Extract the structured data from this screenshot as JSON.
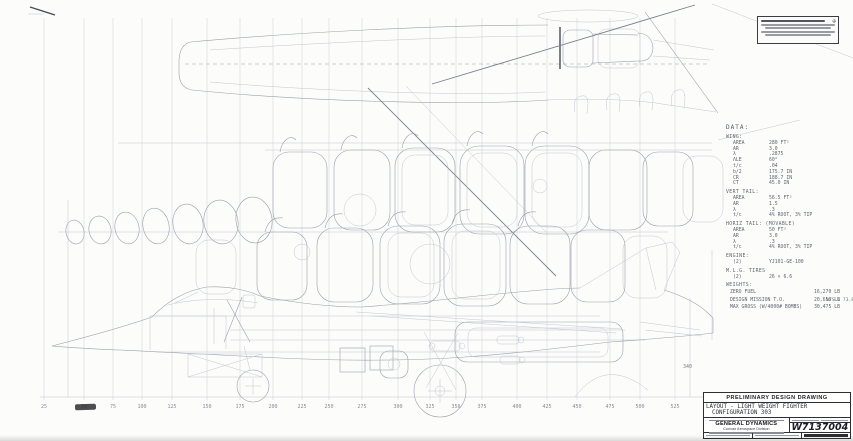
{
  "sheet": {
    "data_block": {
      "heading": "DATA:",
      "sections": [
        {
          "title": "WING:",
          "rows": [
            {
              "label": "AREA",
              "value": "280 FT²"
            },
            {
              "label": "AR",
              "value": "3.0"
            },
            {
              "label": "λ",
              "value": ".2875"
            },
            {
              "label": "ΛLE",
              "value": "60°"
            },
            {
              "label": "t/c",
              "value": ".04"
            },
            {
              "label": "b/2",
              "value": "175.7 IN"
            },
            {
              "label": "CR",
              "value": "188.7 IN"
            },
            {
              "label": "CT",
              "value": "45.0 IN"
            }
          ]
        },
        {
          "title": "VERT TAIL:",
          "rows": [
            {
              "label": "AREA",
              "value": "56.5 FT²"
            },
            {
              "label": "AR",
              "value": "1.5"
            },
            {
              "label": "λ",
              "value": ".3"
            },
            {
              "label": "t/c",
              "value": "4% ROOT, 3% TIP"
            }
          ]
        },
        {
          "title": "HORIZ TAIL: (MOVABLE)",
          "rows": [
            {
              "label": "AREA",
              "value": "50 FT²"
            },
            {
              "label": "AR",
              "value": "3.0"
            },
            {
              "label": "λ",
              "value": ".3"
            },
            {
              "label": "t/c",
              "value": "4% ROOT, 3% TIP"
            }
          ]
        },
        {
          "title": "ENGINE:",
          "rows": [
            {
              "label": "(2)",
              "value": "YJ101-GE-100"
            }
          ]
        },
        {
          "title": "M.L.G. TIRES",
          "rows": [
            {
              "label": "(2)",
              "value": "26 × 6.6"
            }
          ]
        },
        {
          "title": "WEIGHTS:",
          "rows": [
            {
              "label": "ZERO FUEL",
              "value": "16,270 LB"
            },
            {
              "label": "DESIGN MISSION T.O.",
              "value": "20,650 LB"
            },
            {
              "label": "MAX GROSS (W/4000# BOMBS)",
              "value": "30,475 LB"
            }
          ],
          "note": "W/S = 73.8"
        }
      ]
    },
    "station_scale": {
      "labels": [
        "25",
        "50",
        "75",
        "100",
        "125",
        "150",
        "175",
        "200",
        "225",
        "250",
        "275",
        "300",
        "325",
        "350",
        "375",
        "400",
        "425",
        "450",
        "475",
        "500",
        "525"
      ]
    },
    "annotations": {
      "fin_station": "340"
    },
    "title_block": {
      "header": "PRELIMINARY DESIGN DRAWING",
      "title_line1": "LAYOUT - LIGHT WEIGHT FIGHTER",
      "title_line2": "CONFIGURATION  303",
      "company": "GENERAL DYNAMICS",
      "division": "Convair Aerospace Division",
      "drawing_number": "W7137004"
    }
  }
}
